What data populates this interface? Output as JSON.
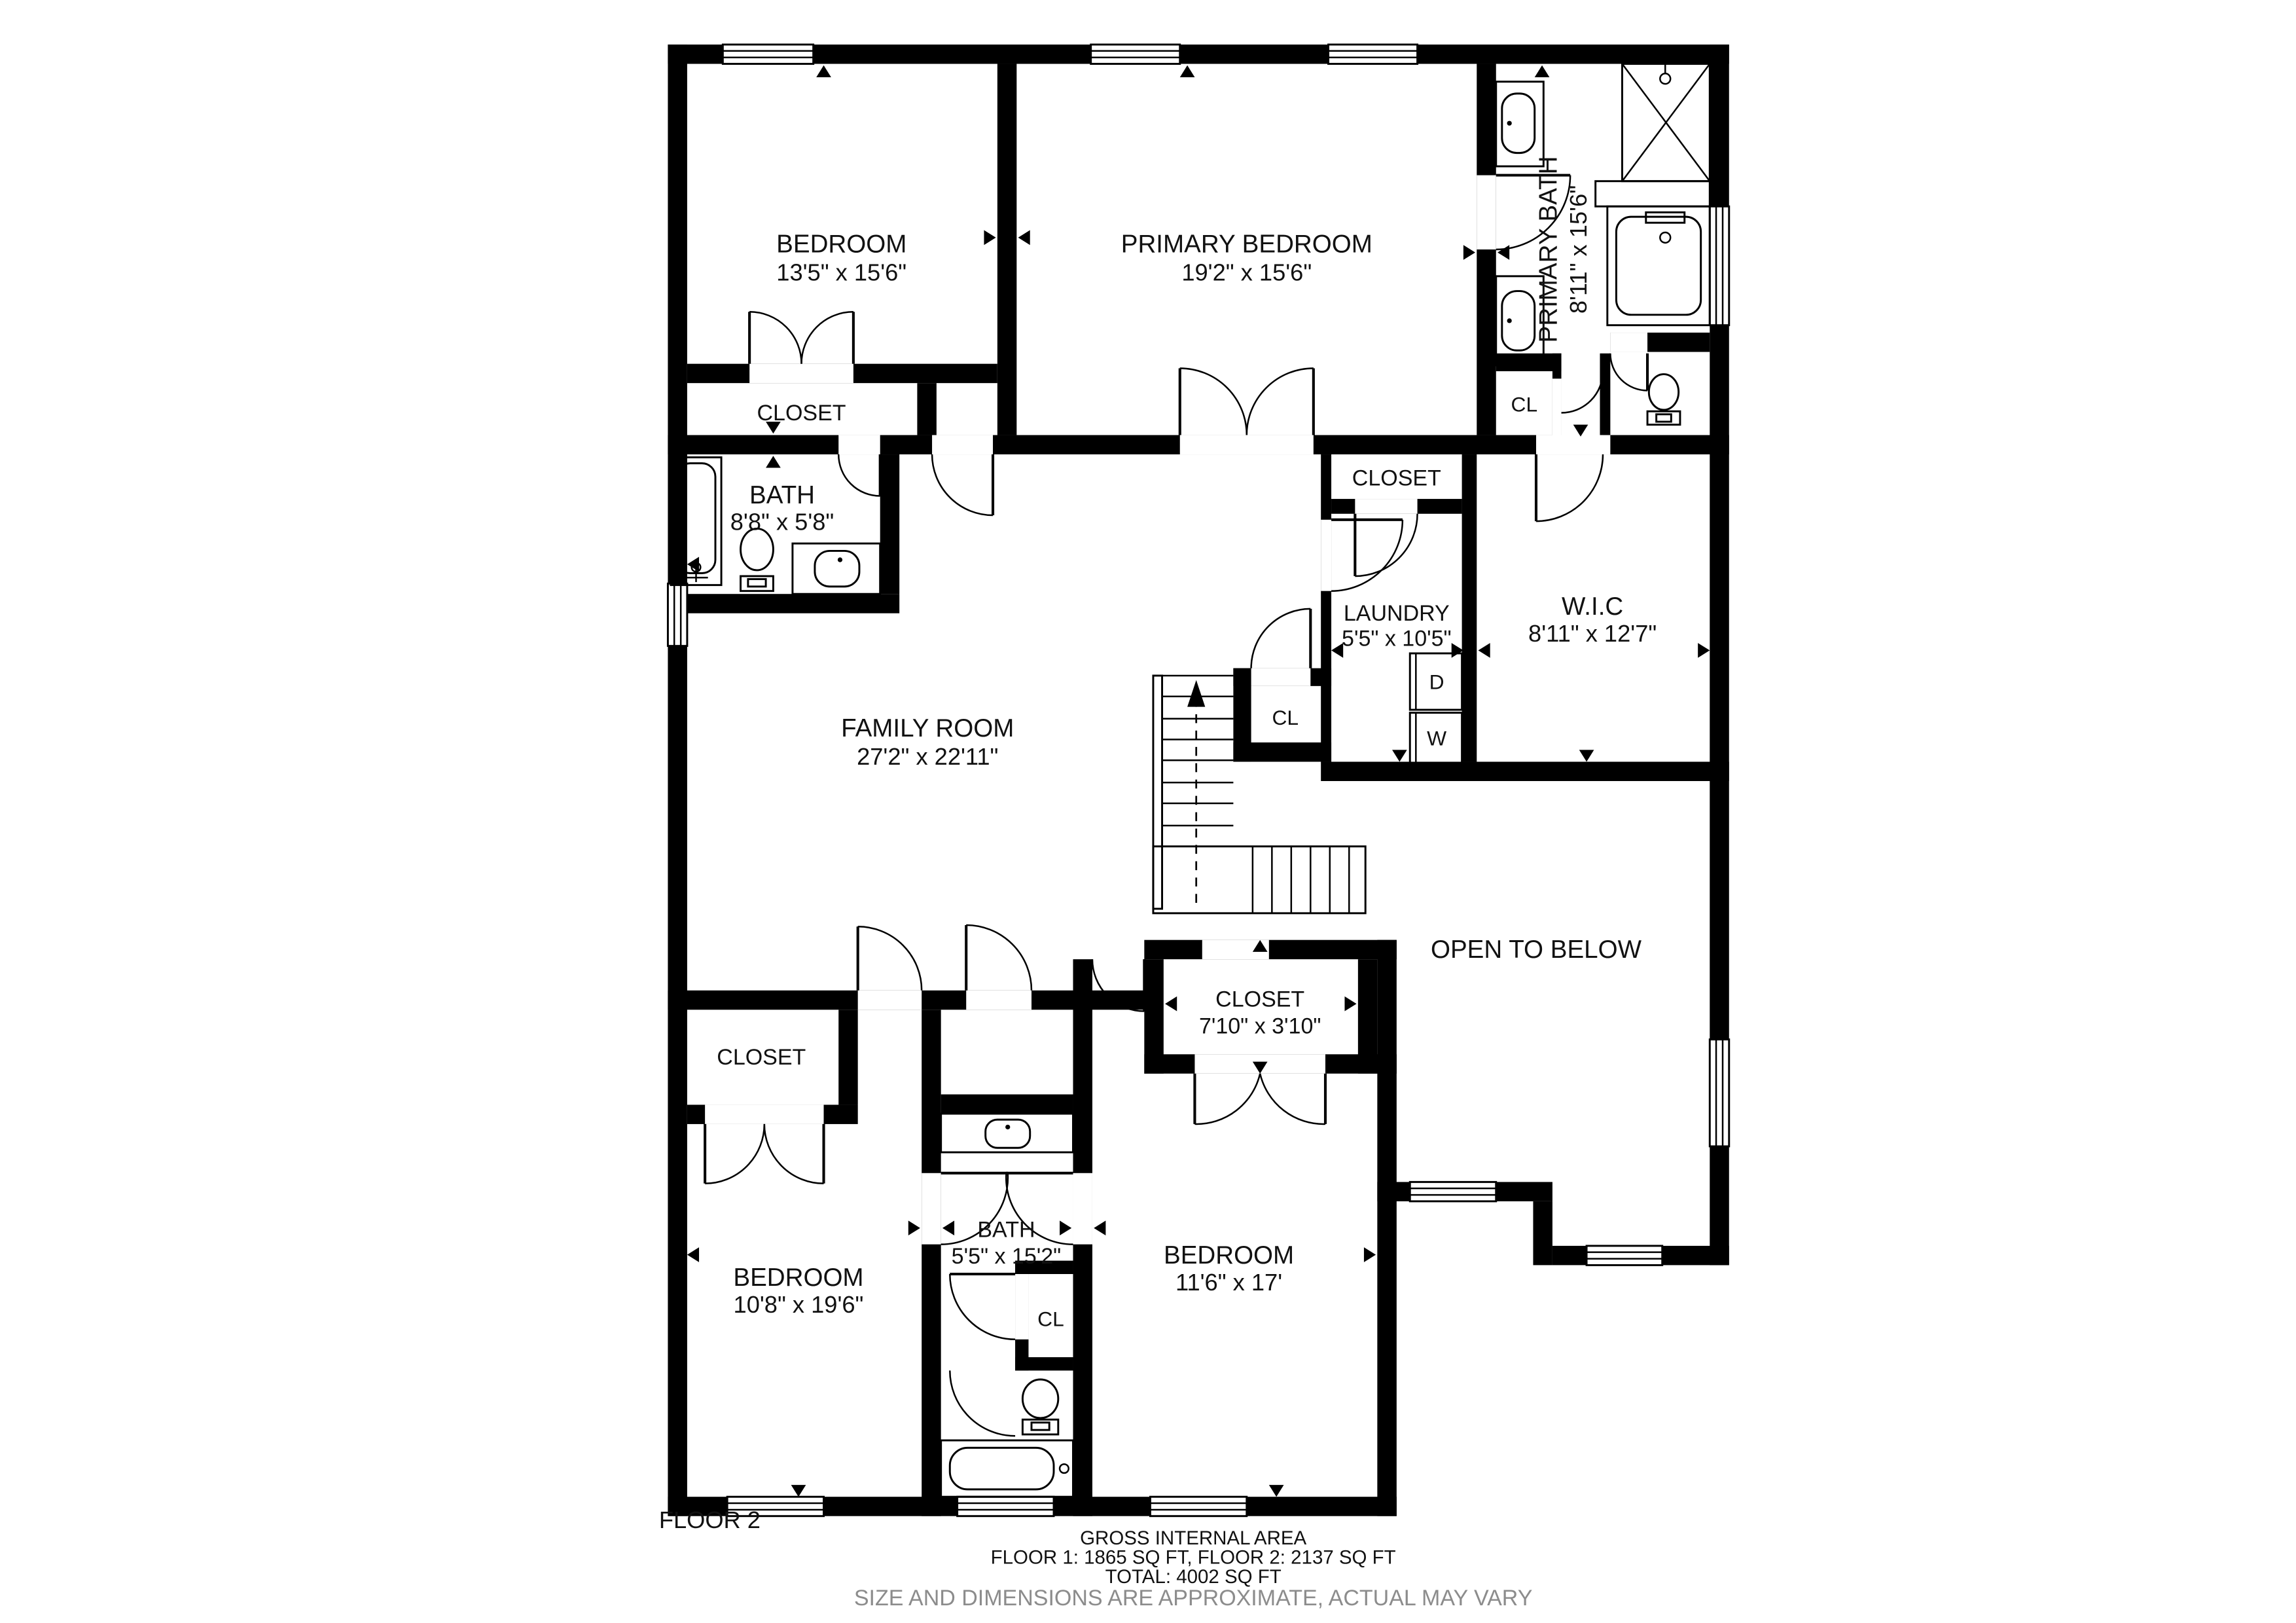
{
  "plan": {
    "floor_label": "FLOOR 2",
    "rooms": {
      "bedroom_top_left": {
        "name": "BEDROOM",
        "dims": "13'5\" x 15'6\""
      },
      "primary_bedroom": {
        "name": "PRIMARY BEDROOM",
        "dims": "19'2\" x 15'6\""
      },
      "primary_bath": {
        "name": "PRIMARY BATH",
        "dims": "8'11\" x 15'6\""
      },
      "closet_top_left": {
        "name": "CLOSET"
      },
      "bath_upper": {
        "name": "BATH",
        "dims": "8'8\" x 5'8\""
      },
      "family_room": {
        "name": "FAMILY ROOM",
        "dims": "27'2\" x 22'11\""
      },
      "closet_hall": {
        "name": "CLOSET"
      },
      "laundry": {
        "name": "LAUNDRY",
        "dims": "5'5\" x 10'5\"",
        "dryer": "D",
        "washer": "W"
      },
      "wic": {
        "name": "W.I.C",
        "dims": "8'11\" x 12'7\""
      },
      "cl_stairs": {
        "name": "CL"
      },
      "cl_primary_bath": {
        "name": "CL"
      },
      "open_to_below": {
        "name": "OPEN TO BELOW"
      },
      "closet_center": {
        "name": "CLOSET",
        "dims": "7'10\" x 3'10\""
      },
      "closet_bottom_left": {
        "name": "CLOSET"
      },
      "bedroom_bottom_left": {
        "name": "BEDROOM",
        "dims": "10'8\" x 19'6\""
      },
      "bath_lower": {
        "name": "BATH",
        "dims": "5'5\" x 15'2\""
      },
      "cl_bath_lower": {
        "name": "CL"
      },
      "bedroom_bottom_right": {
        "name": "BEDROOM",
        "dims": "11'6\" x 17'"
      }
    },
    "icons": {
      "window": "window-icon",
      "door": "door-swing-icon",
      "bathtub": "bathtub-icon",
      "shower": "shower-icon",
      "toilet": "toilet-icon",
      "sink": "sink-icon",
      "washer": "washer-icon",
      "dryer": "dryer-icon",
      "stairs": "stairs-up-icon"
    }
  },
  "footer": {
    "line1": "GROSS INTERNAL AREA",
    "line2": "FLOOR 1: 1865 SQ FT, FLOOR 2: 2137 SQ FT",
    "line3": "TOTAL: 4002 SQ FT",
    "line4": "SIZE AND DIMENSIONS ARE APPROXIMATE, ACTUAL MAY VARY"
  },
  "colors": {
    "wall": "#000000",
    "text": "#111111",
    "muted_text": "#8c8c8c",
    "background": "#ffffff"
  }
}
